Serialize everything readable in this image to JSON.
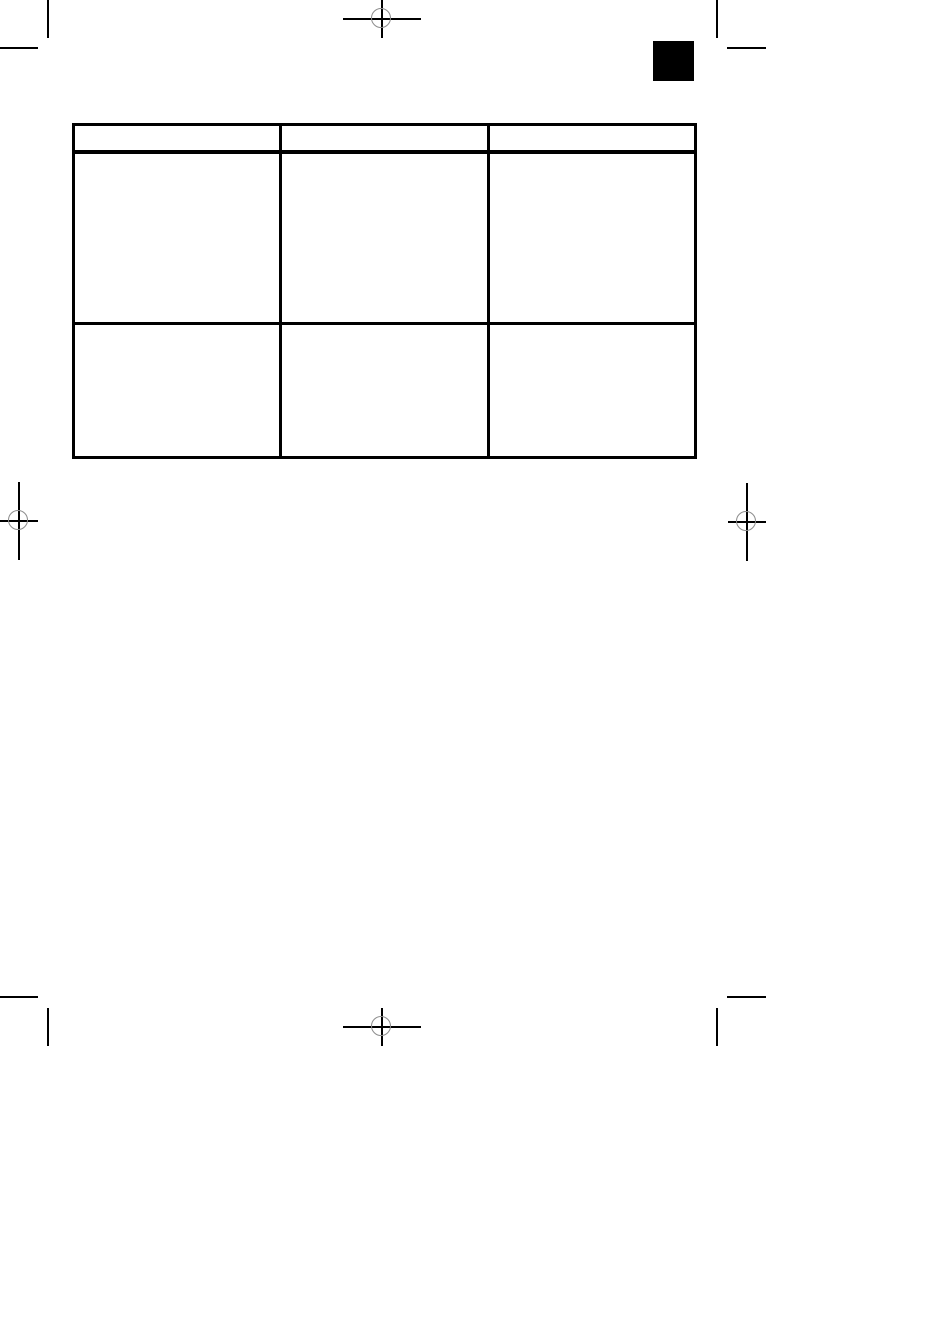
{
  "document": {
    "kind": "print-proof page",
    "page_background": "#ffffff"
  },
  "colors": {
    "rule_black": "#000000",
    "registration_ring_gray": "#8c8c8c",
    "section_square_black": "#000000"
  },
  "marks": {
    "registration": [
      {
        "id": "top-center"
      },
      {
        "id": "left-middle"
      },
      {
        "id": "right-middle"
      },
      {
        "id": "bottom-center"
      }
    ],
    "trim_corners": [
      {
        "id": "top-left"
      },
      {
        "id": "top-right"
      },
      {
        "id": "bottom-left"
      },
      {
        "id": "bottom-right"
      }
    ]
  },
  "table": {
    "columns": 3,
    "header": [
      "",
      "",
      ""
    ],
    "rows": [
      [
        "",
        "",
        ""
      ],
      [
        "",
        "",
        ""
      ]
    ]
  }
}
